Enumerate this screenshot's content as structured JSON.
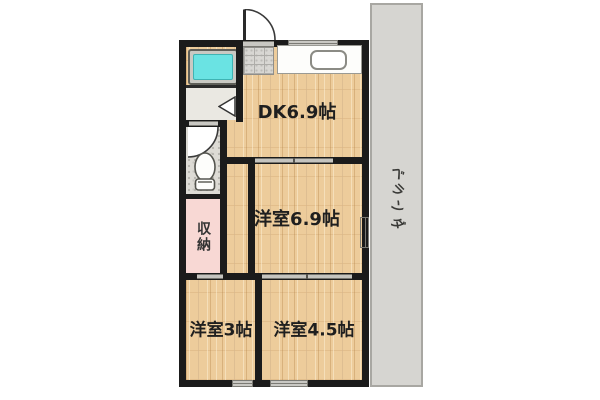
{
  "plan_type": "apartment-floorplan",
  "rooms": {
    "dk": {
      "label": "DK6.9帖"
    },
    "western_69": {
      "label": "洋室6.9帖"
    },
    "western_3": {
      "label": "洋室3帖"
    },
    "western_45": {
      "label": "洋室4.5帖"
    },
    "storage": {
      "label": "収納"
    },
    "veranda": {
      "label": "ベランダ"
    }
  },
  "fixtures": {
    "bathtub": "bathtub-icon",
    "kitchen_sink": "kitchen-sink-icon",
    "toilet": "toilet-icon",
    "entry_door": "door-swing-icon",
    "toilet_door": "door-swing-icon",
    "washroom_door": "door-notch-icon"
  },
  "colors": {
    "wall": "#1b1b1b",
    "wood_floor": "#edcc9b",
    "bath_water": "#6ae3e3",
    "storage_pink": "#f8d8d4",
    "veranda_grey": "#d6d5d1",
    "genkan_tile_grey": "#d8d7d3",
    "washroom_grey": "#eae8e2",
    "toilet_floor_grey": "#dddbd5",
    "opening_grey": "#c9c8c3"
  }
}
